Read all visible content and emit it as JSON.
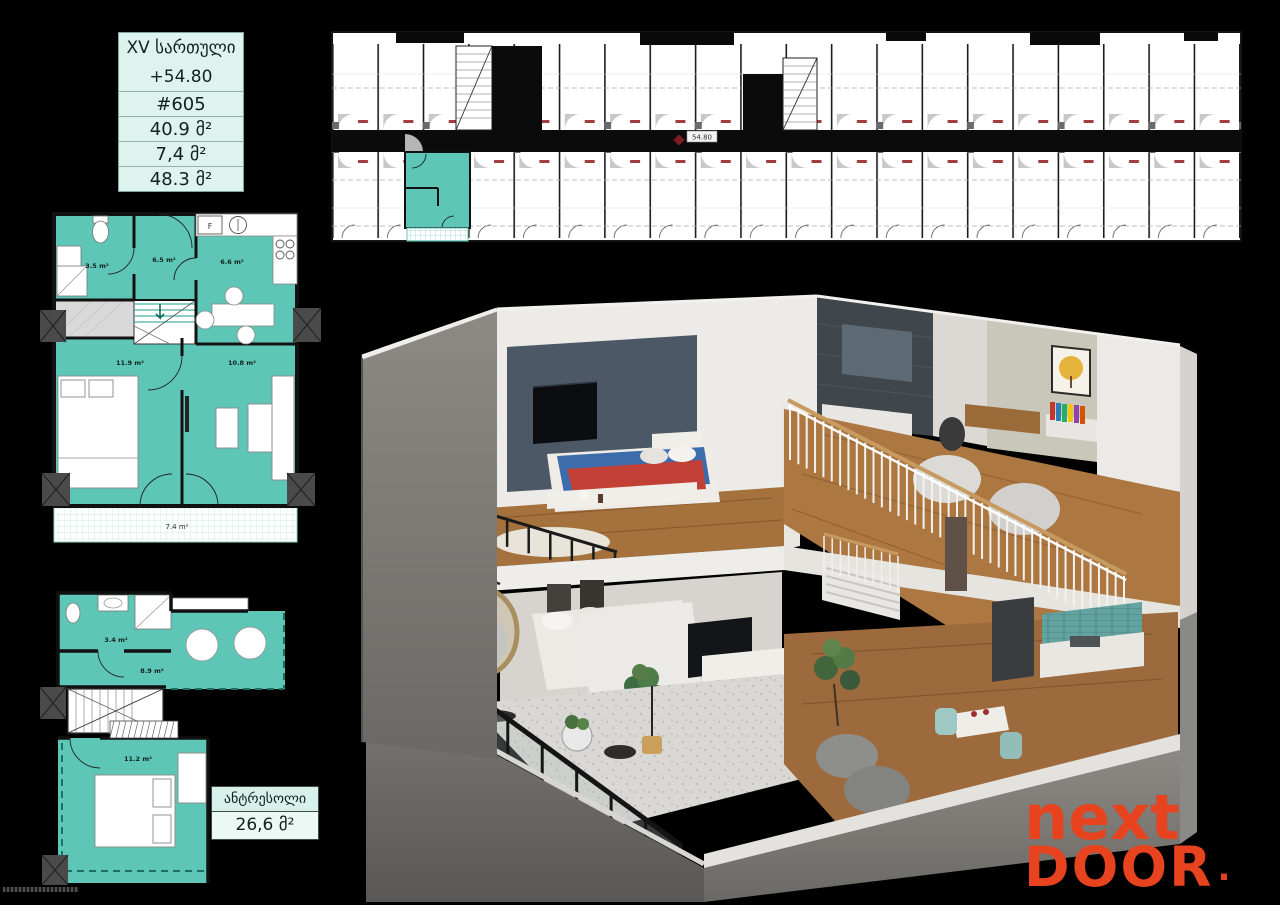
{
  "palette": {
    "background": "#000000",
    "unit_teal": "#5ec6b6",
    "mint_panel": "#dff3ee",
    "brand_orange": "#e8431f"
  },
  "info_table": {
    "rows": [
      {
        "label": "XV სართული"
      },
      {
        "label": "+54.80"
      },
      {
        "label": "#605"
      },
      {
        "label": "40.9 მ²"
      },
      {
        "label": "7,4 მ²"
      },
      {
        "label": "48.3 მ²"
      }
    ]
  },
  "floor_strip": {
    "elevation_label": "54.80"
  },
  "level1_plan": {
    "bathroom_area": "3.5 m²",
    "hall_area": "6.5 m²",
    "kitchen_area": "6.6 m²",
    "bedroom_area": "11.9 m²",
    "living_area": "10.8 m²",
    "balcony_area": "7.4 m²",
    "fridge_label": "F"
  },
  "mezzanine_plan": {
    "bathroom_area": "3.4 m²",
    "hall_area": "8.9 m²",
    "bedroom_area": "11.2 m²"
  },
  "mezzanine_box": {
    "title": "ანტრესოლი",
    "area": "26,6 მ²"
  },
  "logo": {
    "line1": "next",
    "line2": "DOOR",
    "dot": "."
  }
}
